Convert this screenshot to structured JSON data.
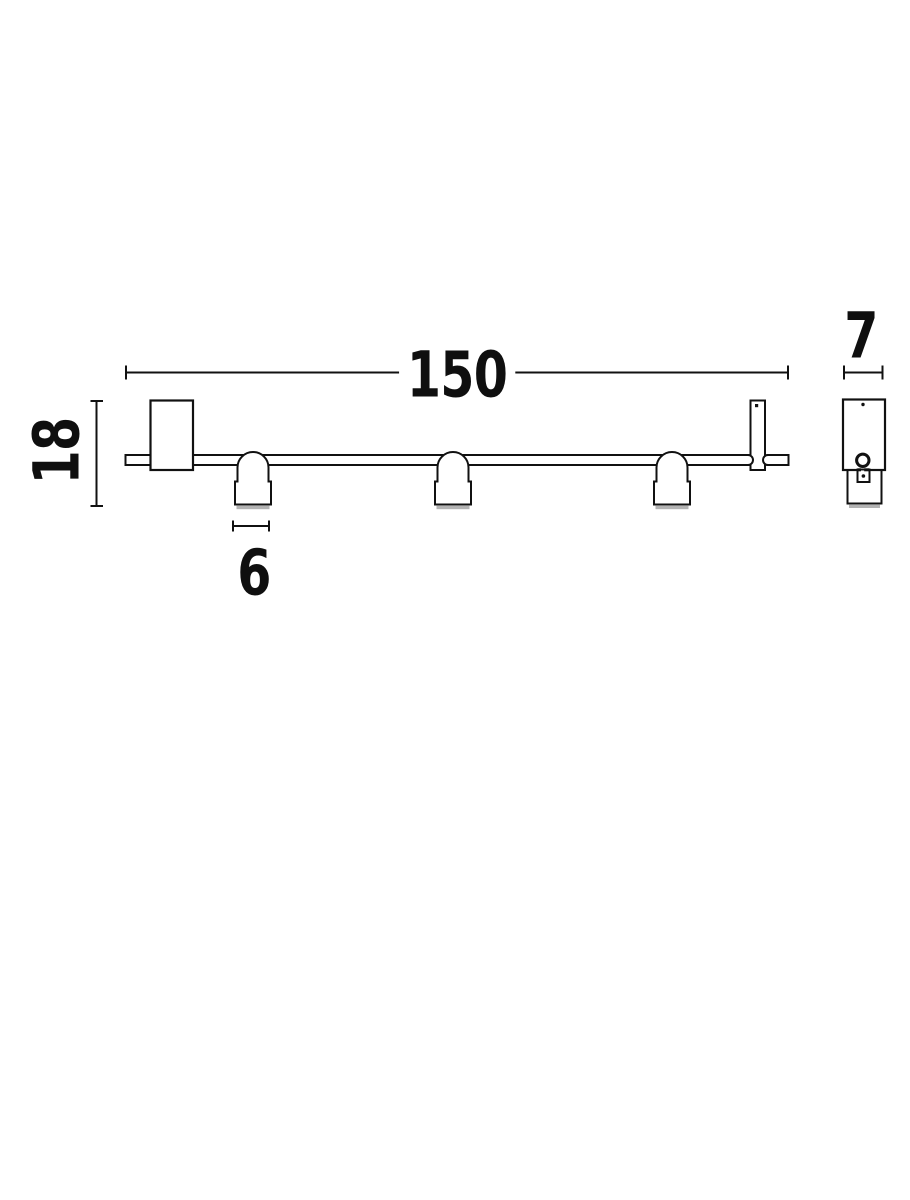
{
  "drawing": {
    "background": "#ffffff",
    "line_color": "#111111",
    "shadow_color": "#999999",
    "dimensions": {
      "length": {
        "value": "150"
      },
      "height": {
        "value": "18"
      },
      "head_width": {
        "value": "6"
      },
      "depth": {
        "value": "7"
      }
    }
  }
}
